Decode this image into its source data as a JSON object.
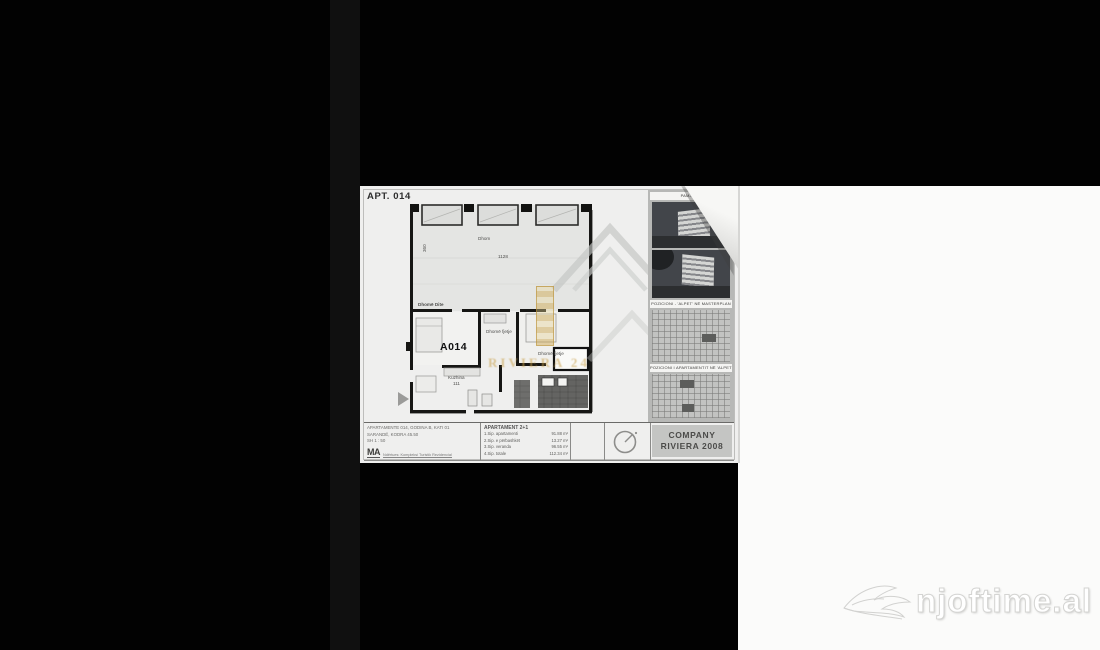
{
  "viewer": {
    "watermark": "njoftime.al"
  },
  "doc": {
    "title": "APT. 014",
    "unit": "A014",
    "plan": {
      "terrace_label": "Dhom",
      "terrace_dim": "1128",
      "terrace_dim_v": "360",
      "room_left": "Dhomë Dite",
      "room_mid": "Dhomë fjetje",
      "room_right": "Dhomë fjetje",
      "kitchen": "Kuzhina",
      "kitchen_dim": "111"
    },
    "watermark": {
      "brand": "RIVIERA 24"
    },
    "sidebar": {
      "caption_top": "PAMJE 3D",
      "caption_mid": "POZICIONI - 'ALPET' NË MASTERPLAN",
      "caption_low": "POZICIONI I APARTAMENTIT NË 'ALPET'"
    },
    "titleblock": {
      "left_lines": [
        "APARTAMENTE 014, GODINA B, KATI 01",
        "SARANDË, KODRA 45.50",
        "SH 1 : 50"
      ],
      "logo": "MA",
      "logo_line": "Ndërtues: Kompleksi Turistik Rezidencial",
      "areas": {
        "header": "APARTAMENT 2+1",
        "rows": [
          {
            "label": "1.Sip. apartamenti",
            "value": "91.88 m²"
          },
          {
            "label": "2.Sip. e përbashkët",
            "value": "13.27 m²"
          },
          {
            "label": "3.Sip. veranda",
            "value": "96.55 m²"
          },
          {
            "label": "4.Sip. totale",
            "value": "112.34 m²"
          }
        ]
      },
      "company_line1": "COMPANY",
      "company_line2": "RIVIERA 2008"
    }
  },
  "colors": {
    "letterbox": "#020202",
    "paper": "#efefee",
    "gold": "#c9a04a",
    "sidebar_gray": "#b7b8b6"
  }
}
